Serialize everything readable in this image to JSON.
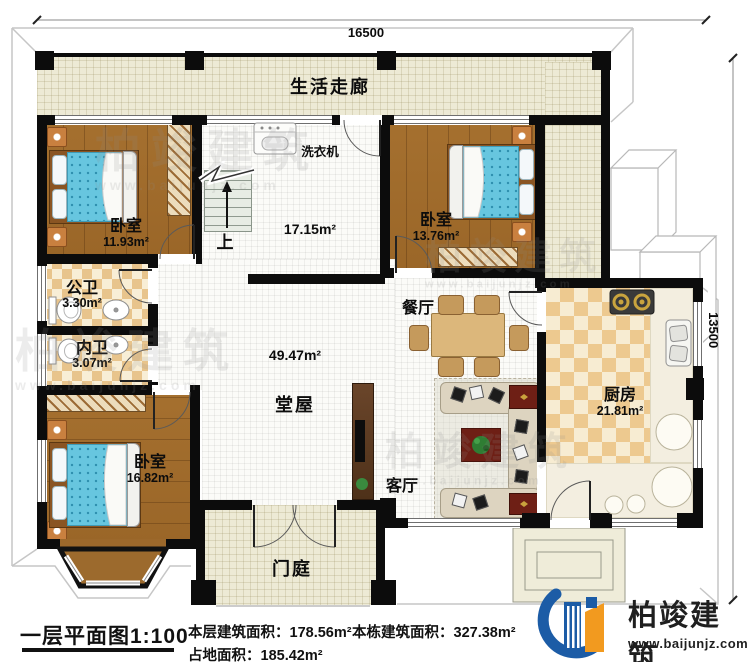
{
  "dimensions": {
    "top": "16500",
    "right": "13500"
  },
  "rooms": {
    "corridor": {
      "label": "生活走廊"
    },
    "bedroom_top_left": {
      "label": "卧室",
      "area": "11.93m²"
    },
    "bedroom_top_right": {
      "label": "卧室",
      "area": "13.76m²"
    },
    "bedroom_bottom_left": {
      "label": "卧室",
      "area": "16.82m²"
    },
    "stair_hall": {
      "area": "17.15m²",
      "washer": "洗衣机",
      "up": "上"
    },
    "public_bath": {
      "label": "公卫",
      "area": "3.30m²"
    },
    "inner_bath": {
      "label": "内卫",
      "area": "3.07m²"
    },
    "dining": {
      "label": "餐厅"
    },
    "hall": {
      "label": "堂屋",
      "area": "49.47m²"
    },
    "living": {
      "label": "客厅"
    },
    "kitchen": {
      "label": "厨房",
      "area": "21.81m²"
    },
    "porch": {
      "label": "门庭"
    }
  },
  "footer": {
    "title": "一层平面图1:100",
    "stats": [
      {
        "label": "本层建筑面积：",
        "value": "178.56m²"
      },
      {
        "label": "本栋建筑面积：",
        "value": "327.38m²"
      },
      {
        "label": "占地面积：",
        "value": "185.42m²"
      }
    ]
  },
  "brand": {
    "name": "柏竣建筑",
    "website": "www.baijunjz.com"
  },
  "watermark": {
    "name": "柏竣建筑",
    "website": "www.baijunjz.com"
  },
  "colors": {
    "wall": "#0c0c0c",
    "corridor_tile": "#edead5",
    "wood_floor": "#a0692c",
    "bath_tile": "#e8c48c",
    "kitchen_tile": "#edc98f",
    "bed_fabric": "#67c6df",
    "logo_blue": "#1c5ca6",
    "logo_orange": "#f29a1f"
  }
}
